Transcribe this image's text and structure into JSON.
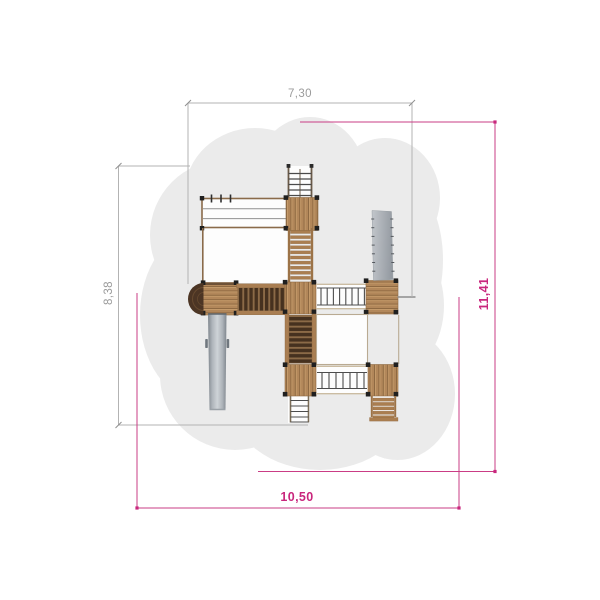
{
  "drawing": {
    "title": "playground-equipment-top-view-plan",
    "equipment_dimensions": {
      "width_label": "7,30",
      "height_label": "8,38",
      "color": "#9b9b9b"
    },
    "safety_dimensions": {
      "width_label": "10,50",
      "height_label": "11,41",
      "color": "#c9277d"
    },
    "colors": {
      "background": "#ffffff",
      "safety_zone": "#ebebeb",
      "wood_plank": "#b2875a",
      "wood_rail": "#9c7347",
      "dark_slat": "#46311f",
      "round_platform": "#4c3524",
      "corner_post": "#1f1f1f",
      "slide_gray": "#c6cbd0"
    },
    "components": [
      "entry-ladder",
      "upper-platform",
      "monkey-bar-frame",
      "wooden-stairs",
      "left-side-rail",
      "left-platform",
      "round-platform",
      "clatter-bridge-horizontal",
      "central-platform",
      "rope-bridge-upper",
      "right-upper-platform",
      "climbing-ramp",
      "fireman-pole-bar",
      "slide",
      "clatter-bridge-vertical",
      "open-frame",
      "lower-central-platform",
      "exit-ladder",
      "rope-bridge-lower",
      "right-lower-platform",
      "access-steps"
    ]
  }
}
